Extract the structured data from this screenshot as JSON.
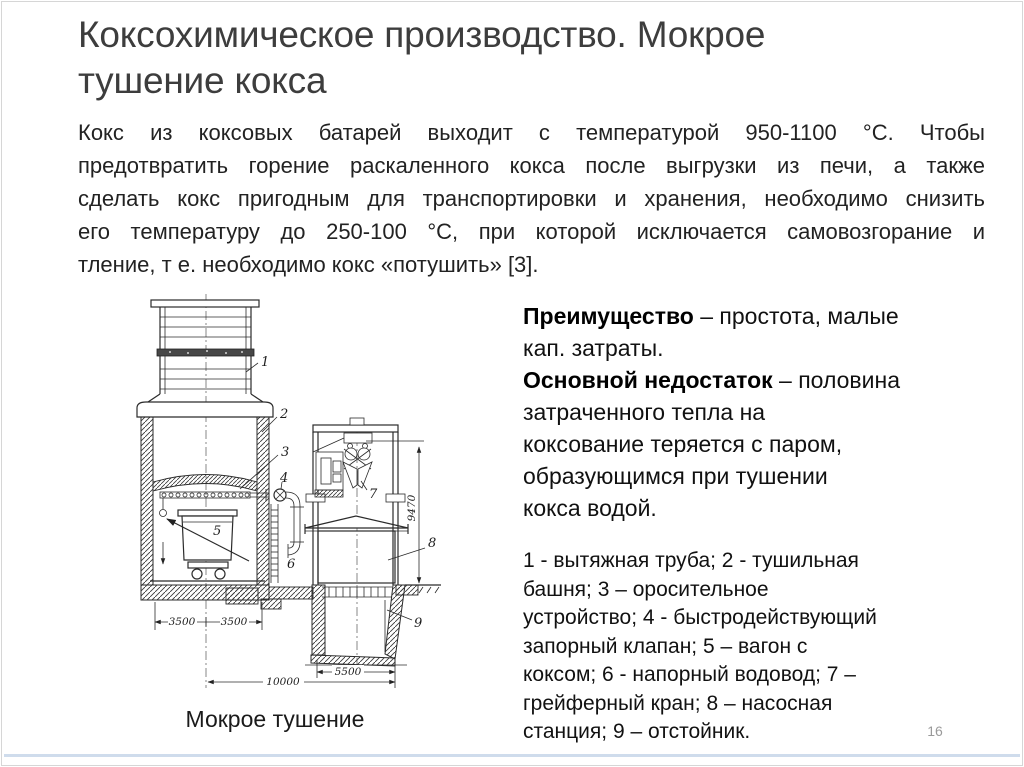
{
  "slide": {
    "title_lines": [
      "Коксохимическое производство. Мокрое",
      "тушение кокса"
    ],
    "page_number": "16",
    "accent_color": "#cfdcec",
    "border_color": "#d6d6d6"
  },
  "body": {
    "lines": [
      "Кокс из коксовых батарей выходит с температурой 950-1100 °С. Чтобы",
      "предотвратить горение раскаленного кокса после выгрузки из печи, а также",
      "сделать кокс пригодным для транспортировки и хранения, необходимо снизить",
      "его температуру до 250-100 °С, при которой исключается самовозгорание и",
      "тление, т е. необходимо кокс «потушить» [3]."
    ]
  },
  "right_panel": {
    "advantage_term": "Преимущество",
    "advantage_rest": " – простота, малые",
    "advantage_line2": "кап. затраты.",
    "drawback_term": "Основной недостаток",
    "drawback_rest": " – половина",
    "drawback_lines": [
      "затраченного тепла на",
      "коксование теряется с паром,",
      "образующимся при тушении",
      "кокса водой."
    ],
    "legend_lines": [
      "1 - вытяжная труба; 2 - тушильная",
      "башня; 3 – оросительное",
      "устройство; 4 - быстродействующий",
      "запорный клапан; 5 – вагон с",
      "коксом; 6 - напорный водовод; 7 –",
      "грейферный кран; 8 – насосная",
      "станция; 9 – отстойник."
    ]
  },
  "figure": {
    "caption": "Мокрое тушение",
    "labels": [
      "1",
      "2",
      "3",
      "4",
      "5",
      "6",
      "7",
      "8",
      "9"
    ],
    "dimensions": {
      "left_a": "3500",
      "left_b": "3500",
      "overall": "10000",
      "pit": "5500",
      "height": "9470"
    }
  }
}
